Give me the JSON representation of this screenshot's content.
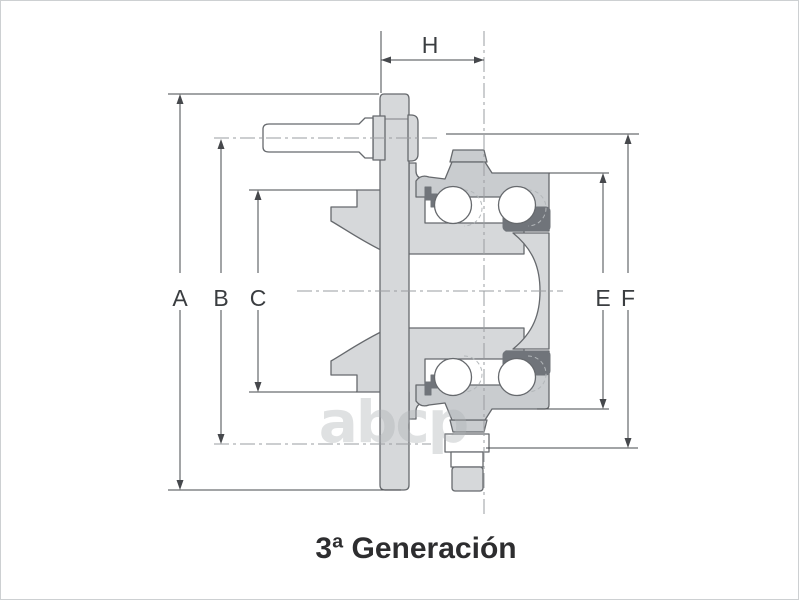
{
  "diagram": {
    "caption": "3ª Generación",
    "watermark": "abcp",
    "dimension_labels": {
      "a": "A",
      "b": "B",
      "c": "C",
      "e": "E",
      "f": "F",
      "h": "H"
    },
    "colors": {
      "bg": "#ffffff",
      "border": "#cdd0d2",
      "part_fill": "#d6d8da",
      "part_fill_darker": "#c9cccf",
      "seal": "#70747a",
      "ball": "#ffffff",
      "outline": "#66696d",
      "dim": "#46484c",
      "centerline": "#9a9da0",
      "ghost": "#b3b7ba",
      "label": "#3a3d40",
      "caption": "#2d2d2f",
      "watermark": "#aeb2b5"
    }
  }
}
